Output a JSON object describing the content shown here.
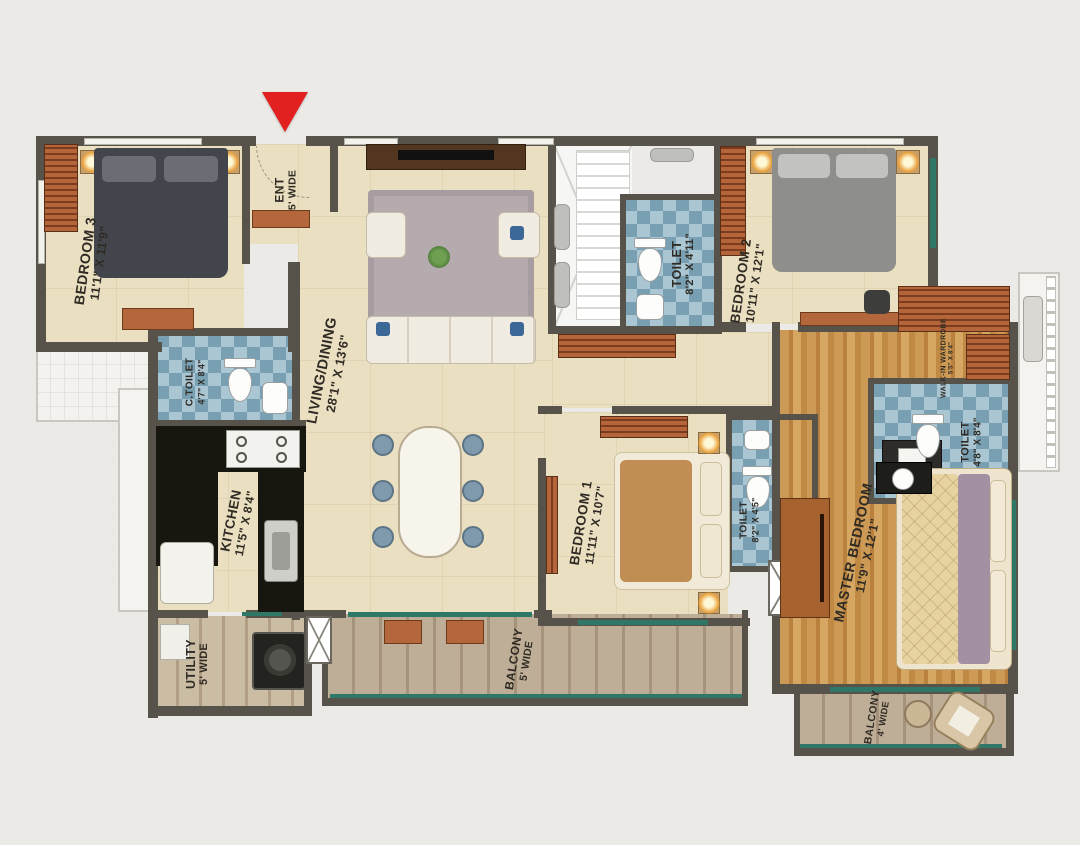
{
  "plan": {
    "type": "apartment-floor-plan",
    "entrance_marker": "main entrance arrow"
  },
  "colors": {
    "wall": "#57534b",
    "floor_beige": "#eadfc0",
    "toilet_tile_blue": "#8fb3c4",
    "wood_floor": "#c8924a",
    "balcony_plank": "#b7a890",
    "window_teal": "#2f7767",
    "entrance_arrow_red": "#e2201f",
    "furniture_brown": "#b4673c"
  },
  "rooms": {
    "bedroom3": {
      "name": "BEDROOM 3",
      "dim": "11'1\" X 11'9\""
    },
    "ent": {
      "name": "ENT",
      "dim": "5' WIDE"
    },
    "living_dining": {
      "name": "LIVING/DINING",
      "dim": "28'1\" X 13'6\""
    },
    "toilet_top": {
      "name": "TOILET",
      "dim": "8'2\" X 4'11\""
    },
    "bedroom2": {
      "name": "BEDROOM 2",
      "dim": "10'11\" X 12'1\""
    },
    "c_toilet": {
      "name": "C.TOILET",
      "dim": "4'7\" X 8'4\""
    },
    "kitchen": {
      "name": "KITCHEN",
      "dim": "11'5\" X 8'4\""
    },
    "utility": {
      "name": "UTILITY",
      "dim": "5' WIDE"
    },
    "bedroom1": {
      "name": "BEDROOM 1",
      "dim": "11'11\" X 10'7\""
    },
    "toilet_bed1": {
      "name": "TOILET",
      "dim": "8'2\" X 4'5\""
    },
    "master_bedroom": {
      "name": "MASTER BEDROOM",
      "dim": "11'9\" X 12'1\""
    },
    "toilet_master": {
      "name": "TOILET",
      "dim": "4'8\" X 8'4\""
    },
    "walkin_wardrobe": {
      "name": "WALK-IN WARDROBE",
      "dim": "5'5\" X 8'4\""
    },
    "balcony_main": {
      "name": "BALCONY",
      "dim": "5' WIDE"
    },
    "balcony_master": {
      "name": "BALCONY",
      "dim": "4' WIDE"
    }
  }
}
